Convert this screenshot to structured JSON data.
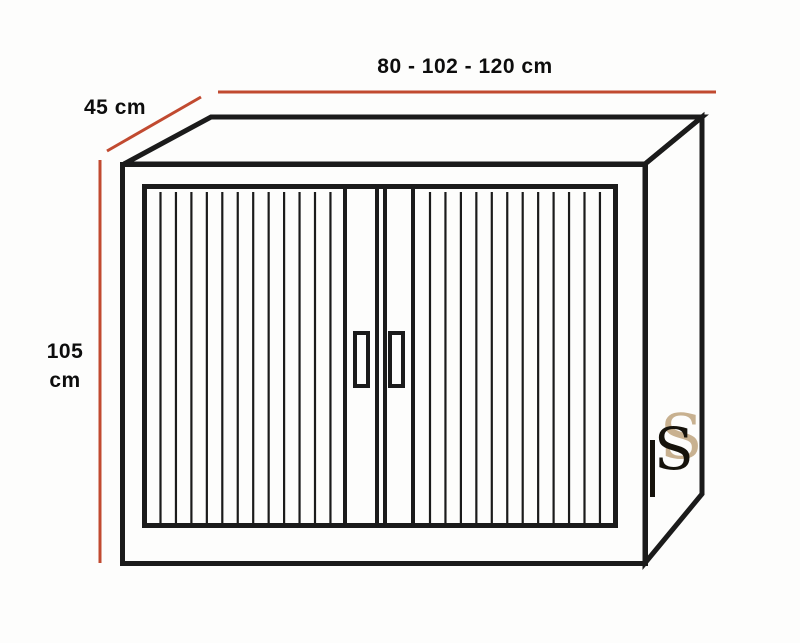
{
  "colors": {
    "background": "#fdfdfc",
    "line": "#1b1b1b",
    "dimension_red": "#c14a30",
    "text": "#0d0d0d",
    "logo_tan": "#c8b190",
    "logo_black": "#16130c"
  },
  "dimensions": {
    "width_label": "80 - 102 - 120 cm",
    "width_values_cm": [
      80,
      102,
      120
    ],
    "depth_label": "45 cm",
    "depth_value_cm": 45,
    "height_label_line1": "105",
    "height_label_line2": "cm",
    "height_value_cm": 105
  },
  "cabinet": {
    "type": "tambour-door cabinet line drawing",
    "doors": [
      {
        "side": "left",
        "slat_count": 12
      },
      {
        "side": "right",
        "slat_count": 12
      }
    ]
  },
  "logo": {
    "glyph_tan": "S",
    "glyph_black": "S"
  }
}
